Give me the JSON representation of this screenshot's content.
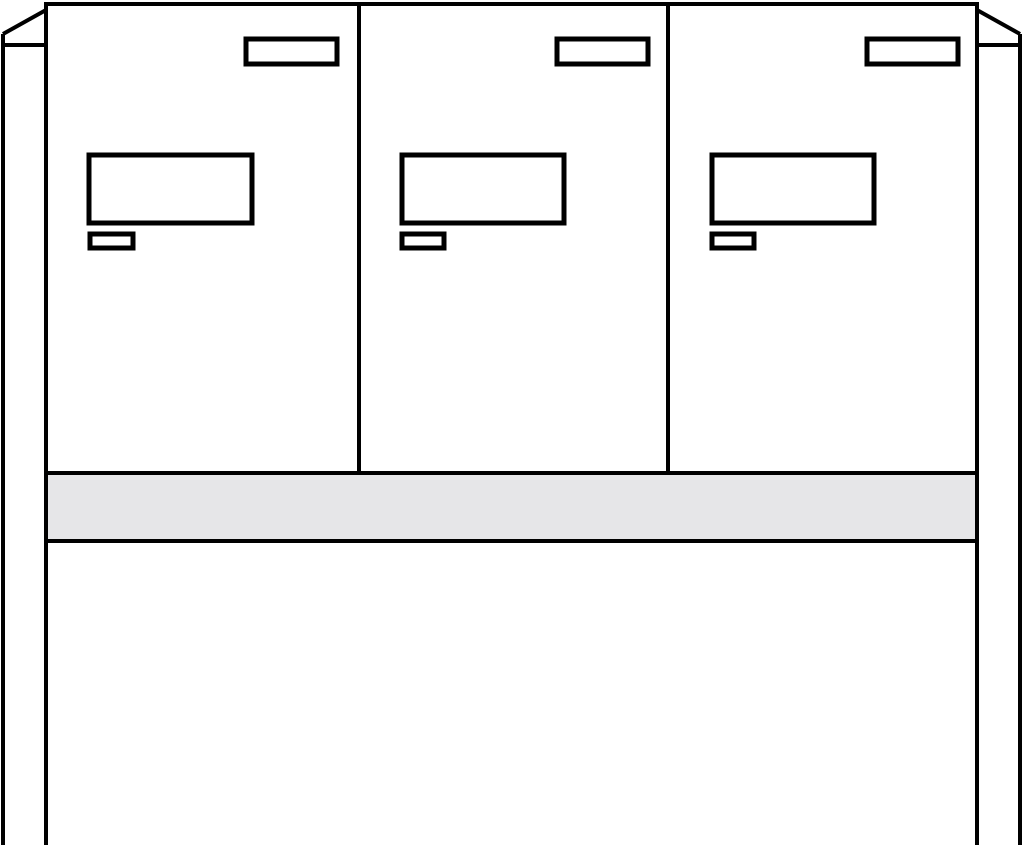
{
  "diagram": {
    "description": "Front-view line drawing of a free-standing letterbox unit with three compartments on two stand posts",
    "compartment_count": 3,
    "compartments": [
      {
        "name": "compartment-1",
        "parts": [
          "name-plate",
          "letter-flap",
          "lock"
        ]
      },
      {
        "name": "compartment-2",
        "parts": [
          "name-plate",
          "letter-flap",
          "lock"
        ]
      },
      {
        "name": "compartment-3",
        "parts": [
          "name-plate",
          "letter-flap",
          "lock"
        ]
      }
    ],
    "other_parts": [
      "left-stand-post",
      "right-stand-post",
      "plinth-rail",
      "lower-panel"
    ]
  },
  "colors": {
    "background": "#ffffff",
    "stroke": "#000000",
    "panel_fill": "#ffffff",
    "plinth_fill": "#e6e6e8"
  }
}
